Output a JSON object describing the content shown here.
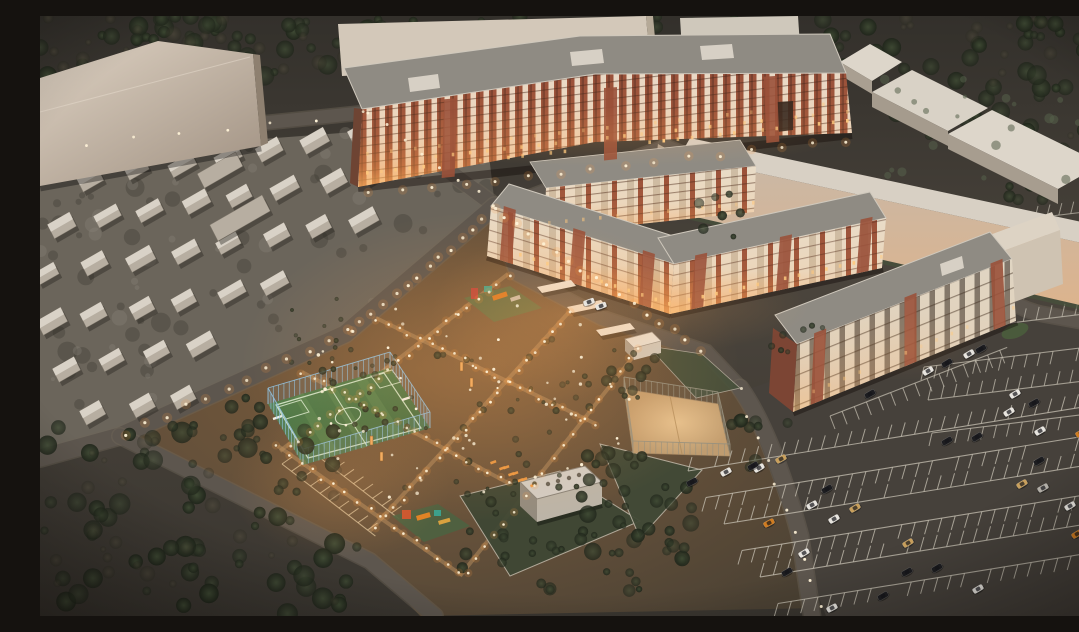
{
  "meta": {
    "title": "Aerial dusk 3D render of a residential complex",
    "description": "Night-time aerial architectural visualization: brick apartment blocks with lit windows, an illuminated courtyard with playgrounds and lamps, a blue-fenced football pitch, a sand sports court, rows of small gabled houses, beige massing blocks, warehouses, forests and large parking lots with cars."
  },
  "palette": {
    "ground": "#45403a",
    "ground_dark": "#33302a",
    "road": "#5d564e",
    "curb": "#6e6659",
    "lot": "#46413b",
    "massing": "#d8ccbd",
    "massing_shadow": "#9a8b7d",
    "brick": "#9a513a",
    "brick_dark": "#7c4534",
    "facade_cream": "#e9dcc8",
    "roof_gray": "#8f8b83",
    "roof_light": "#d8d0c4",
    "glow_warm": "#e09a55",
    "glow_hot": "#ffc97e",
    "pitch_green": "#4e7a4a",
    "pitch_line": "#d8ead0",
    "fence_blue": "#8fc3e4",
    "fence_gray": "#97917f",
    "sand": "#cfa97c",
    "tree_dark": "#232a1e",
    "tree_mid": "#39422f",
    "shrub_green": "#47523b",
    "light_dot": "#fff3d8",
    "line_white": "#c9c3b5",
    "line_warm": "#e7cfa6",
    "house_roof": "#d9d2c7",
    "house_side": "#b7aea1",
    "car_white": "#e8e5df",
    "car_silver": "#b9b5ad",
    "car_black": "#1d1d20",
    "car_tan": "#c9a05c",
    "car_orange": "#d07c20"
  },
  "scene": {
    "time_of_day": "dusk",
    "objects": [
      {
        "name": "apartment-block-9-story",
        "label": "Long 9-storey brick apartment building with lit lower floors, top center"
      },
      {
        "name": "apartment-block-5-story",
        "label": "U-shaped 5-storey apartment building, center"
      },
      {
        "name": "apartment-block-4-story",
        "label": "4-storey apartment building with brick end wall, right"
      },
      {
        "name": "massing-block-northwest",
        "label": "Large untextured beige block, top left"
      },
      {
        "name": "massing-slab-north",
        "label": "Untextured slab behind tall building"
      },
      {
        "name": "perimeter-building-northeast",
        "label": "Long blank building along north-east edge"
      },
      {
        "name": "warehouses-northeast",
        "count": 4
      },
      {
        "name": "house-district-west",
        "label": "Grid of small gabled houses",
        "count_approx": 40
      },
      {
        "name": "football-pitch",
        "label": "Green mini-football pitch with blue fence and goals"
      },
      {
        "name": "sand-court",
        "label": "Fenced sand sports court"
      },
      {
        "name": "playground-north",
        "label": "Playground with colored equipment"
      },
      {
        "name": "playground-south",
        "label": "Second playground with slides"
      },
      {
        "name": "courtyard",
        "label": "Warmly illuminated courtyard with paths, lamp posts, shrubs, canopies and kiosk"
      },
      {
        "name": "utility-building",
        "label": "White flat-roof utility building with rooftop vents"
      },
      {
        "name": "parking-lot-southeast",
        "label": "Large marked parking lot, bottom right"
      },
      {
        "name": "parking-lot-east",
        "label": "Parking rows beside 4-storey building"
      },
      {
        "name": "forest-southwest",
        "label": "Dark tree mass, bottom left"
      },
      {
        "name": "forest-north",
        "label": "Tree band along top edge"
      },
      {
        "name": "vehicles",
        "count": 38
      }
    ]
  },
  "vehicles": [
    {
      "x": 907,
      "y": 425,
      "a": -30,
      "c": "black"
    },
    {
      "x": 937,
      "y": 421,
      "a": -32,
      "c": "black"
    },
    {
      "x": 1000,
      "y": 415,
      "a": -30,
      "c": "white"
    },
    {
      "x": 1041,
      "y": 417,
      "a": -28,
      "c": "orange"
    },
    {
      "x": 1061,
      "y": 432,
      "a": -32,
      "c": "black"
    },
    {
      "x": 999,
      "y": 445,
      "a": -30,
      "c": "black"
    },
    {
      "x": 982,
      "y": 468,
      "a": -31,
      "c": "tan"
    },
    {
      "x": 1003,
      "y": 472,
      "a": -29,
      "c": "silver"
    },
    {
      "x": 1030,
      "y": 490,
      "a": -30,
      "c": "white"
    },
    {
      "x": 1037,
      "y": 518,
      "a": -31,
      "c": "orange"
    },
    {
      "x": 787,
      "y": 473,
      "a": -30,
      "c": "black"
    },
    {
      "x": 772,
      "y": 489,
      "a": -29,
      "c": "white"
    },
    {
      "x": 815,
      "y": 492,
      "a": -31,
      "c": "tan"
    },
    {
      "x": 794,
      "y": 503,
      "a": -30,
      "c": "white"
    },
    {
      "x": 729,
      "y": 507,
      "a": -28,
      "c": "orange"
    },
    {
      "x": 764,
      "y": 537,
      "a": -30,
      "c": "white"
    },
    {
      "x": 868,
      "y": 527,
      "a": -31,
      "c": "tan"
    },
    {
      "x": 747,
      "y": 556,
      "a": -30,
      "c": "black"
    },
    {
      "x": 867,
      "y": 556,
      "a": -29,
      "c": "black"
    },
    {
      "x": 897,
      "y": 552,
      "a": -31,
      "c": "black"
    },
    {
      "x": 938,
      "y": 573,
      "a": -30,
      "c": "white"
    },
    {
      "x": 843,
      "y": 580,
      "a": -30,
      "c": "black"
    },
    {
      "x": 792,
      "y": 592,
      "a": -28,
      "c": "white"
    },
    {
      "x": 719,
      "y": 452,
      "a": -30,
      "c": "white"
    },
    {
      "x": 652,
      "y": 466,
      "a": -28,
      "c": "black"
    },
    {
      "x": 686,
      "y": 456,
      "a": -29,
      "c": "white"
    },
    {
      "x": 713,
      "y": 450,
      "a": -30,
      "c": "black"
    },
    {
      "x": 741,
      "y": 443,
      "a": -29,
      "c": "tan"
    },
    {
      "x": 888,
      "y": 355,
      "a": -30,
      "c": "white"
    },
    {
      "x": 907,
      "y": 347,
      "a": -31,
      "c": "black"
    },
    {
      "x": 929,
      "y": 338,
      "a": -30,
      "c": "white"
    },
    {
      "x": 941,
      "y": 333,
      "a": -30,
      "c": "black"
    },
    {
      "x": 975,
      "y": 378,
      "a": -30,
      "c": "white"
    },
    {
      "x": 994,
      "y": 387,
      "a": -29,
      "c": "black"
    },
    {
      "x": 969,
      "y": 396,
      "a": -31,
      "c": "white"
    },
    {
      "x": 1048,
      "y": 352,
      "a": -30,
      "c": "orange"
    },
    {
      "x": 830,
      "y": 378,
      "a": -30,
      "c": "black"
    },
    {
      "x": 1051,
      "y": 209,
      "a": -25,
      "c": "white"
    },
    {
      "x": 1068,
      "y": 219,
      "a": -26,
      "c": "tan"
    },
    {
      "x": 549,
      "y": 286,
      "a": -20,
      "c": "white"
    },
    {
      "x": 561,
      "y": 290,
      "a": -20,
      "c": "white"
    }
  ]
}
